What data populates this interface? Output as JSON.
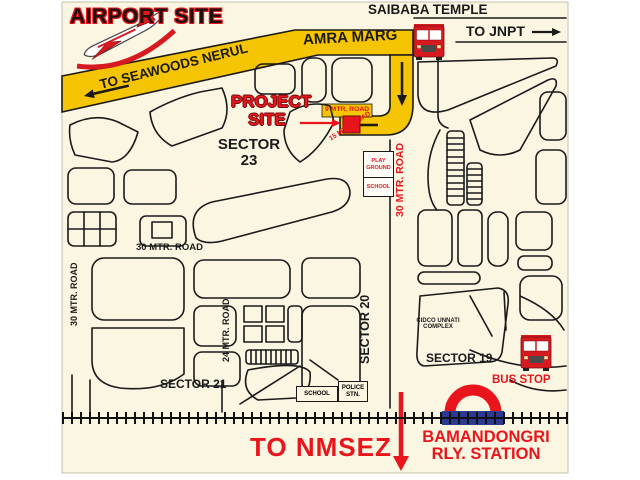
{
  "header": {
    "airport_site": "AIRPORT SITE",
    "saibaba_temple": "SAIBABA TEMPLE"
  },
  "directions": {
    "seawoods": "TO SEAWOODS NERUL",
    "jnpt": "TO JNPT",
    "nmsez": "TO NMSEZ"
  },
  "roads": {
    "amra_marg": "AMRA MARG",
    "mtr9": "9 MTR. ROAD",
    "mtr15": "15 MTR. ROAD",
    "mtr30_project": "30 MTR. ROAD",
    "mtr30_horizontal": "30 MTR. ROAD",
    "mtr30_left": "30 MTR. ROAD",
    "mtr24": "24 MTR. ROAD"
  },
  "sectors": {
    "s23_l1": "SECTOR",
    "s23_l2": "23",
    "s21": "SECTOR 21",
    "s20": "SECTOR 20",
    "s19": "SECTOR 19"
  },
  "project": {
    "l1": "PROJECT",
    "l2": "SITE"
  },
  "landmarks": {
    "play_ground": "PLAY GROUND",
    "school_sector23": "SCHOOL",
    "cidco_l1": "CIDCO UNNATI",
    "cidco_l2": "COMPLEX",
    "school_s19": "SCHOOL",
    "police_l1": "POLICE",
    "police_l2": "STN.",
    "bus_stop": "BUS STOP",
    "station_l1": "BAMANDONGRI",
    "station_l2": "RLY. STATION"
  },
  "icons": {
    "airplane": "airplane-icon",
    "bus_top": "bus-icon",
    "bus_bottom": "bus-icon",
    "railway_roundel": "railway-roundel-icon",
    "railway_track": "railway-track"
  },
  "colors": {
    "background": "#FBF6E2",
    "road_yellow": "#F5C402",
    "accent_red": "#E8151C",
    "rail_blue": "#2B3990",
    "ink": "#1A1A1A"
  }
}
